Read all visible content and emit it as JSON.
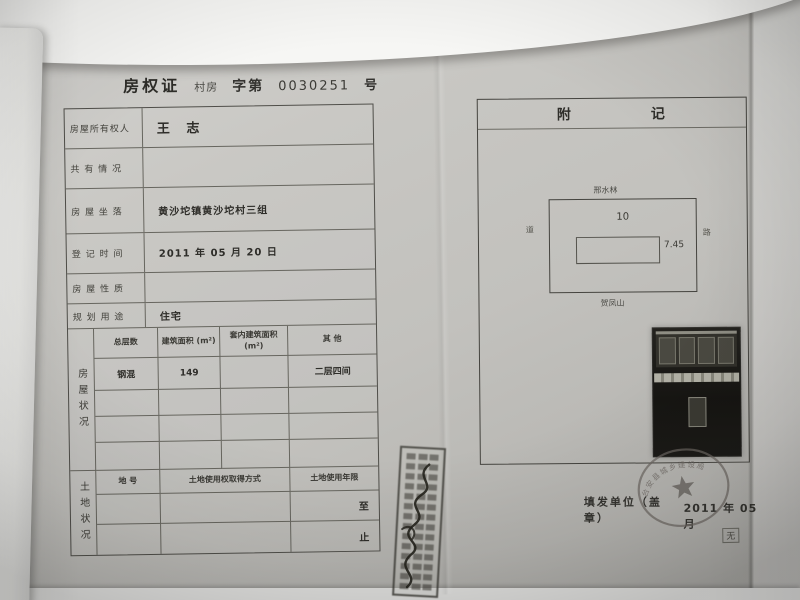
{
  "certificate": {
    "title": "房权证",
    "type_label": "村房",
    "series_label": "字第",
    "serial_number": "0030251",
    "number_suffix": "号"
  },
  "owner_table": {
    "rows": [
      {
        "label": "房屋所有权人",
        "value": "王 志"
      },
      {
        "label": "共 有 情 况",
        "value": ""
      },
      {
        "label": "房 屋 坐 落",
        "value": "黄沙坨镇黄沙坨村三组"
      },
      {
        "label": "登 记 时 间",
        "value": "2011 年 05 月 20 日"
      },
      {
        "label": "房 屋 性 质",
        "value": ""
      },
      {
        "label": "规 划 用 途",
        "value": "住宅"
      }
    ]
  },
  "house_status": {
    "side_label": "房屋状况",
    "headers": [
      "总层数",
      "建筑面积 (m²)",
      "套内建筑面积 (m²)",
      "其 他"
    ],
    "rows": [
      [
        "钢混",
        "149",
        "",
        "二层四间"
      ],
      [
        "",
        "",
        "",
        ""
      ],
      [
        "",
        "",
        "",
        ""
      ],
      [
        "",
        "",
        "",
        ""
      ]
    ]
  },
  "land_status": {
    "side_label": "土地状况",
    "headers": [
      "地 号",
      "土地使用权取得方式",
      "土地使用年限"
    ],
    "rows": [
      [
        "",
        "",
        "至"
      ],
      [
        "",
        "",
        "止"
      ]
    ]
  },
  "annex": {
    "header_chars": [
      "附",
      "记"
    ],
    "plot_diagram": {
      "north_label": "邢水林",
      "south_label": "贺凤山",
      "west_label": "道",
      "east_label": "路",
      "width_dim": "10",
      "depth_dim": "7.45"
    },
    "issue_label": "填发单位（盖章）",
    "issue_date": "2011 年 05 月",
    "seal_text": "台安县城乡建设局",
    "page_mark": "无"
  },
  "colors": {
    "paper": "#c2c1bd",
    "ink": "#34332e",
    "seal": "#6b6560"
  }
}
